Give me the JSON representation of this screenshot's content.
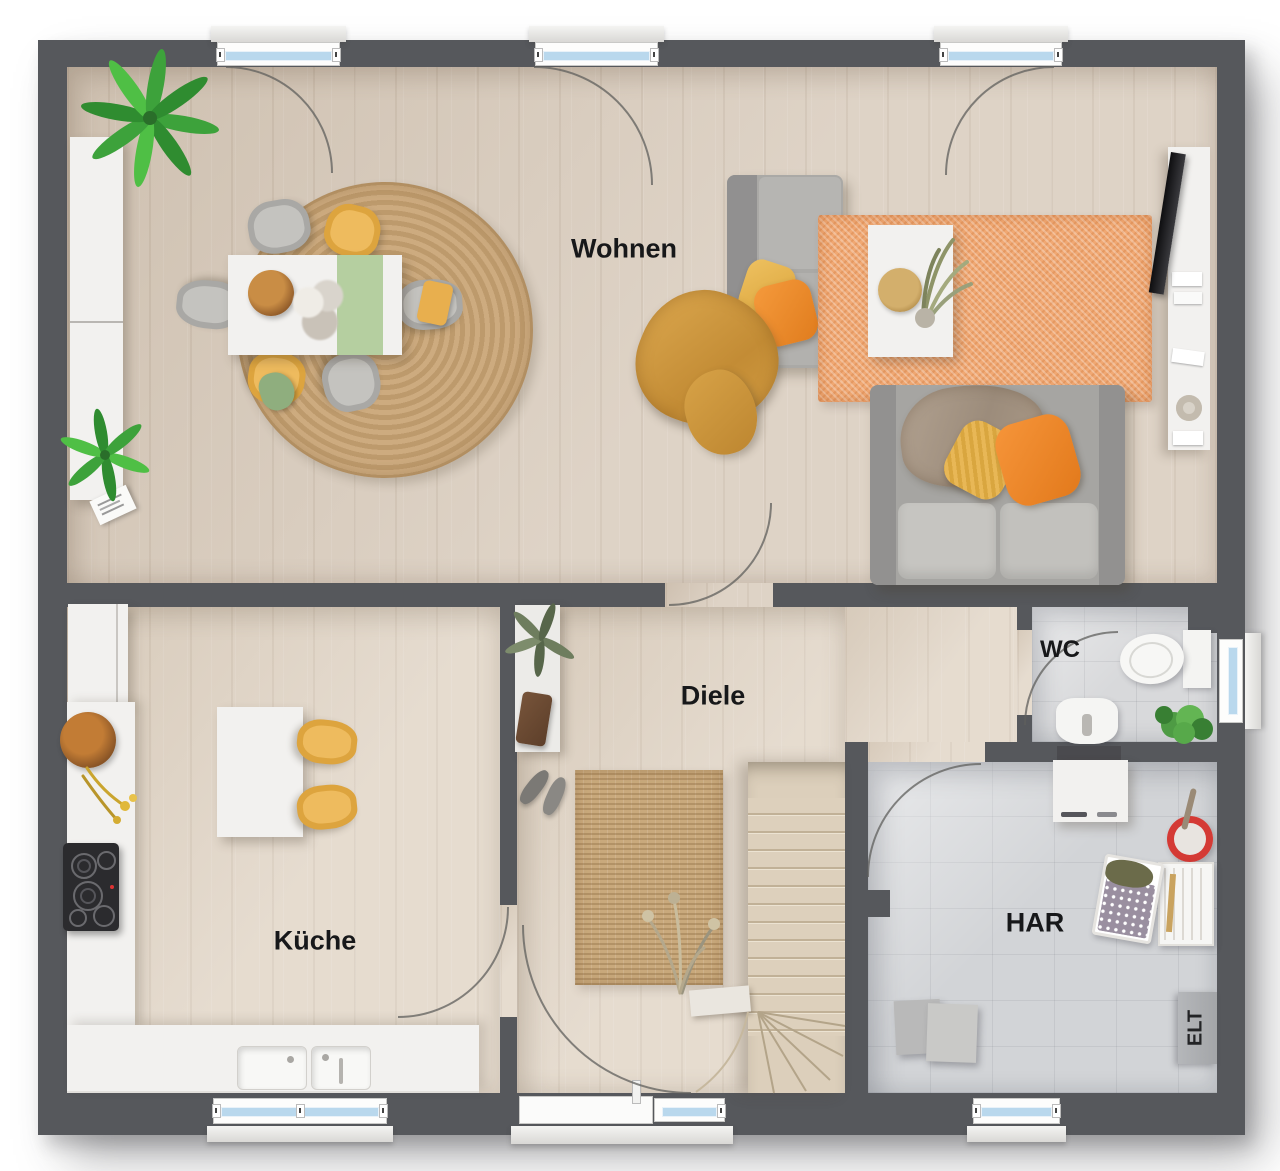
{
  "rooms": {
    "wohnen": "Wohnen",
    "kueche": "Küche",
    "diele": "Diele",
    "wc": "WC",
    "har": "HAR",
    "elt": "ELT"
  },
  "colors": {
    "wall": "#56585c",
    "floor_wood": "#d9ccbd",
    "floor_tile": "#d6d7d9",
    "window_glass": "#b9d8ed",
    "rug_round_jute": "#c9a87e",
    "rug_orange": "#f0a873",
    "rug_hall_jute": "#c9a97c",
    "sofa_gray": "#a8a7a4",
    "accent_yellow": "#e9b457",
    "accent_orange": "#f08c2e",
    "accent_green_runner": "#b5cfa0",
    "plant_green": "#44a83d",
    "stairs_wood": "#dccfbb"
  }
}
